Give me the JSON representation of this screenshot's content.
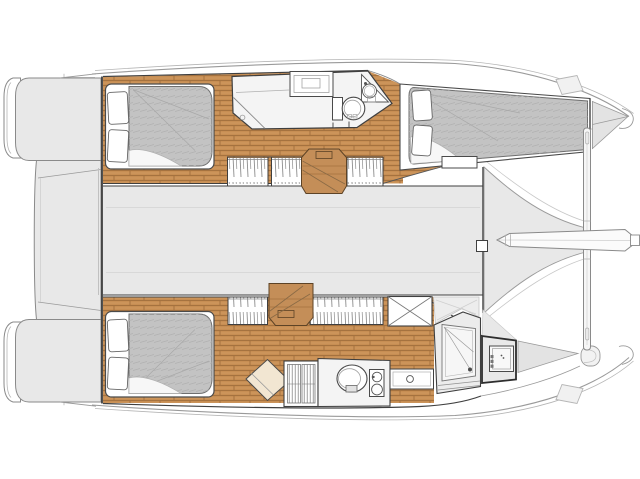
{
  "document": {
    "title": "Catamaran interior layout plan",
    "type": "yacht-floor-plan",
    "view": "top-down deck plan, bow to the right",
    "canvas": {
      "width": 640,
      "height": 479
    }
  },
  "vessel": {
    "hull_count": 2,
    "orientation": "bow-right"
  },
  "colors": {
    "background": "#ffffff",
    "deck": "#e8e8e8",
    "deckLight": "#f1f1f1",
    "wood": "#c78e53",
    "woodSeam": "#a5723f",
    "woodLight": "#e0aa72",
    "stairWood": "#c48e58",
    "stairEdge": "#5d4326",
    "stairLine": "#8a6a45",
    "mattress": "#c3c3c3",
    "mattressHatch": "#b0b0b0",
    "bathFloor": "#f4f4f4",
    "fixtureWhite": "#ffffff",
    "outlineDark": "#3f3f3f",
    "outlineMid": "#8a8a8a",
    "outlineLight": "#b5b5b5",
    "blindStroke": "#8d8d8d",
    "wardrobe": "#f2e6d2"
  },
  "areas": {
    "stern": [
      "port transom steps",
      "starboard transom steps",
      "aft cockpit"
    ],
    "salon": "bridgedeck saloon (empty floor)",
    "foredeck": "foredeck walkway funnel",
    "trampoline": "bow trampoline area",
    "starboard_hull": {
      "aft_cabin": "double berth with two pillows",
      "head": "bathroom with shower, vanity sink, corner basin and toilet",
      "forward_cabin": "double berth with two pillows and foot locker",
      "bow": "anchor locker"
    },
    "port_hull": {
      "aft_cabin": "double berth with two pillows",
      "wardrobe": "angled wardrobe",
      "doors": "louvered double door",
      "head": "bathroom with toilet and basin column",
      "vanity": "counter with round sink",
      "shower": "shower stall with drain",
      "bow": "forepeak storage box with locker hatch"
    }
  },
  "fixtures": [
    "toilet",
    "washbasin",
    "shower-drain",
    "berth",
    "pillow",
    "companionway-stairs",
    "window-blinds",
    "crossbeam",
    "bowsprit",
    "deck-hatch",
    "sliding-door-handle"
  ]
}
